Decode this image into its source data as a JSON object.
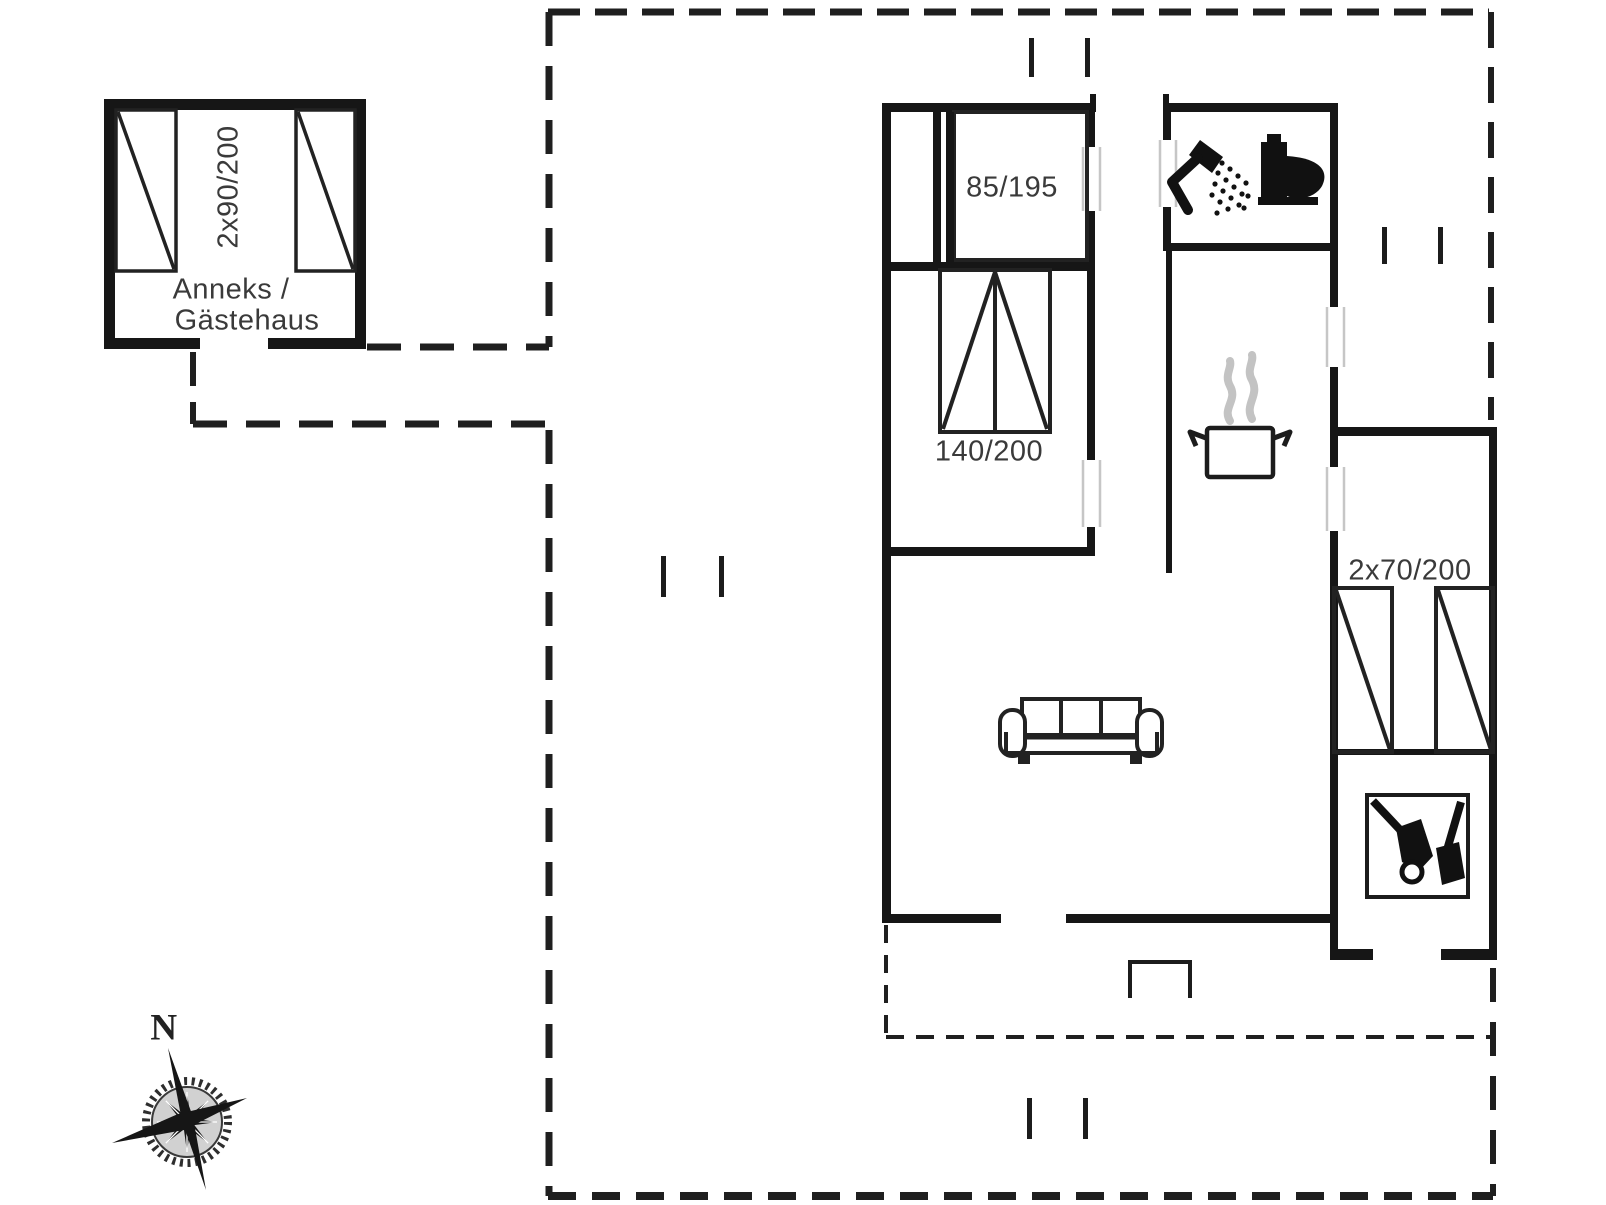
{
  "plan": {
    "title_hint": "holiday house floor plan",
    "annex": {
      "name_line1": "Anneks /",
      "name_line2": "Gästehaus",
      "bed_label": "2x90/200"
    },
    "rooms": {
      "bedroom_1_bed_label": "85/195",
      "bedroom_2_bed_label": "140/200",
      "bedroom_3_bed_label": "2x70/200"
    },
    "compass": {
      "north_label": "N"
    },
    "colors": {
      "background": "#ffffff",
      "wall": "#161616",
      "boundary_line": "#1f1f1f",
      "label_text": "#3a3a3a",
      "door_rail": "#c6c6c6",
      "steam": "#c3c3c3"
    },
    "icons": [
      "shower-icon",
      "toilet-icon",
      "cooking-pot-icon",
      "sofa-icon",
      "garden-tools-icon",
      "compass-rose-icon",
      "entrance-step-icon"
    ]
  }
}
